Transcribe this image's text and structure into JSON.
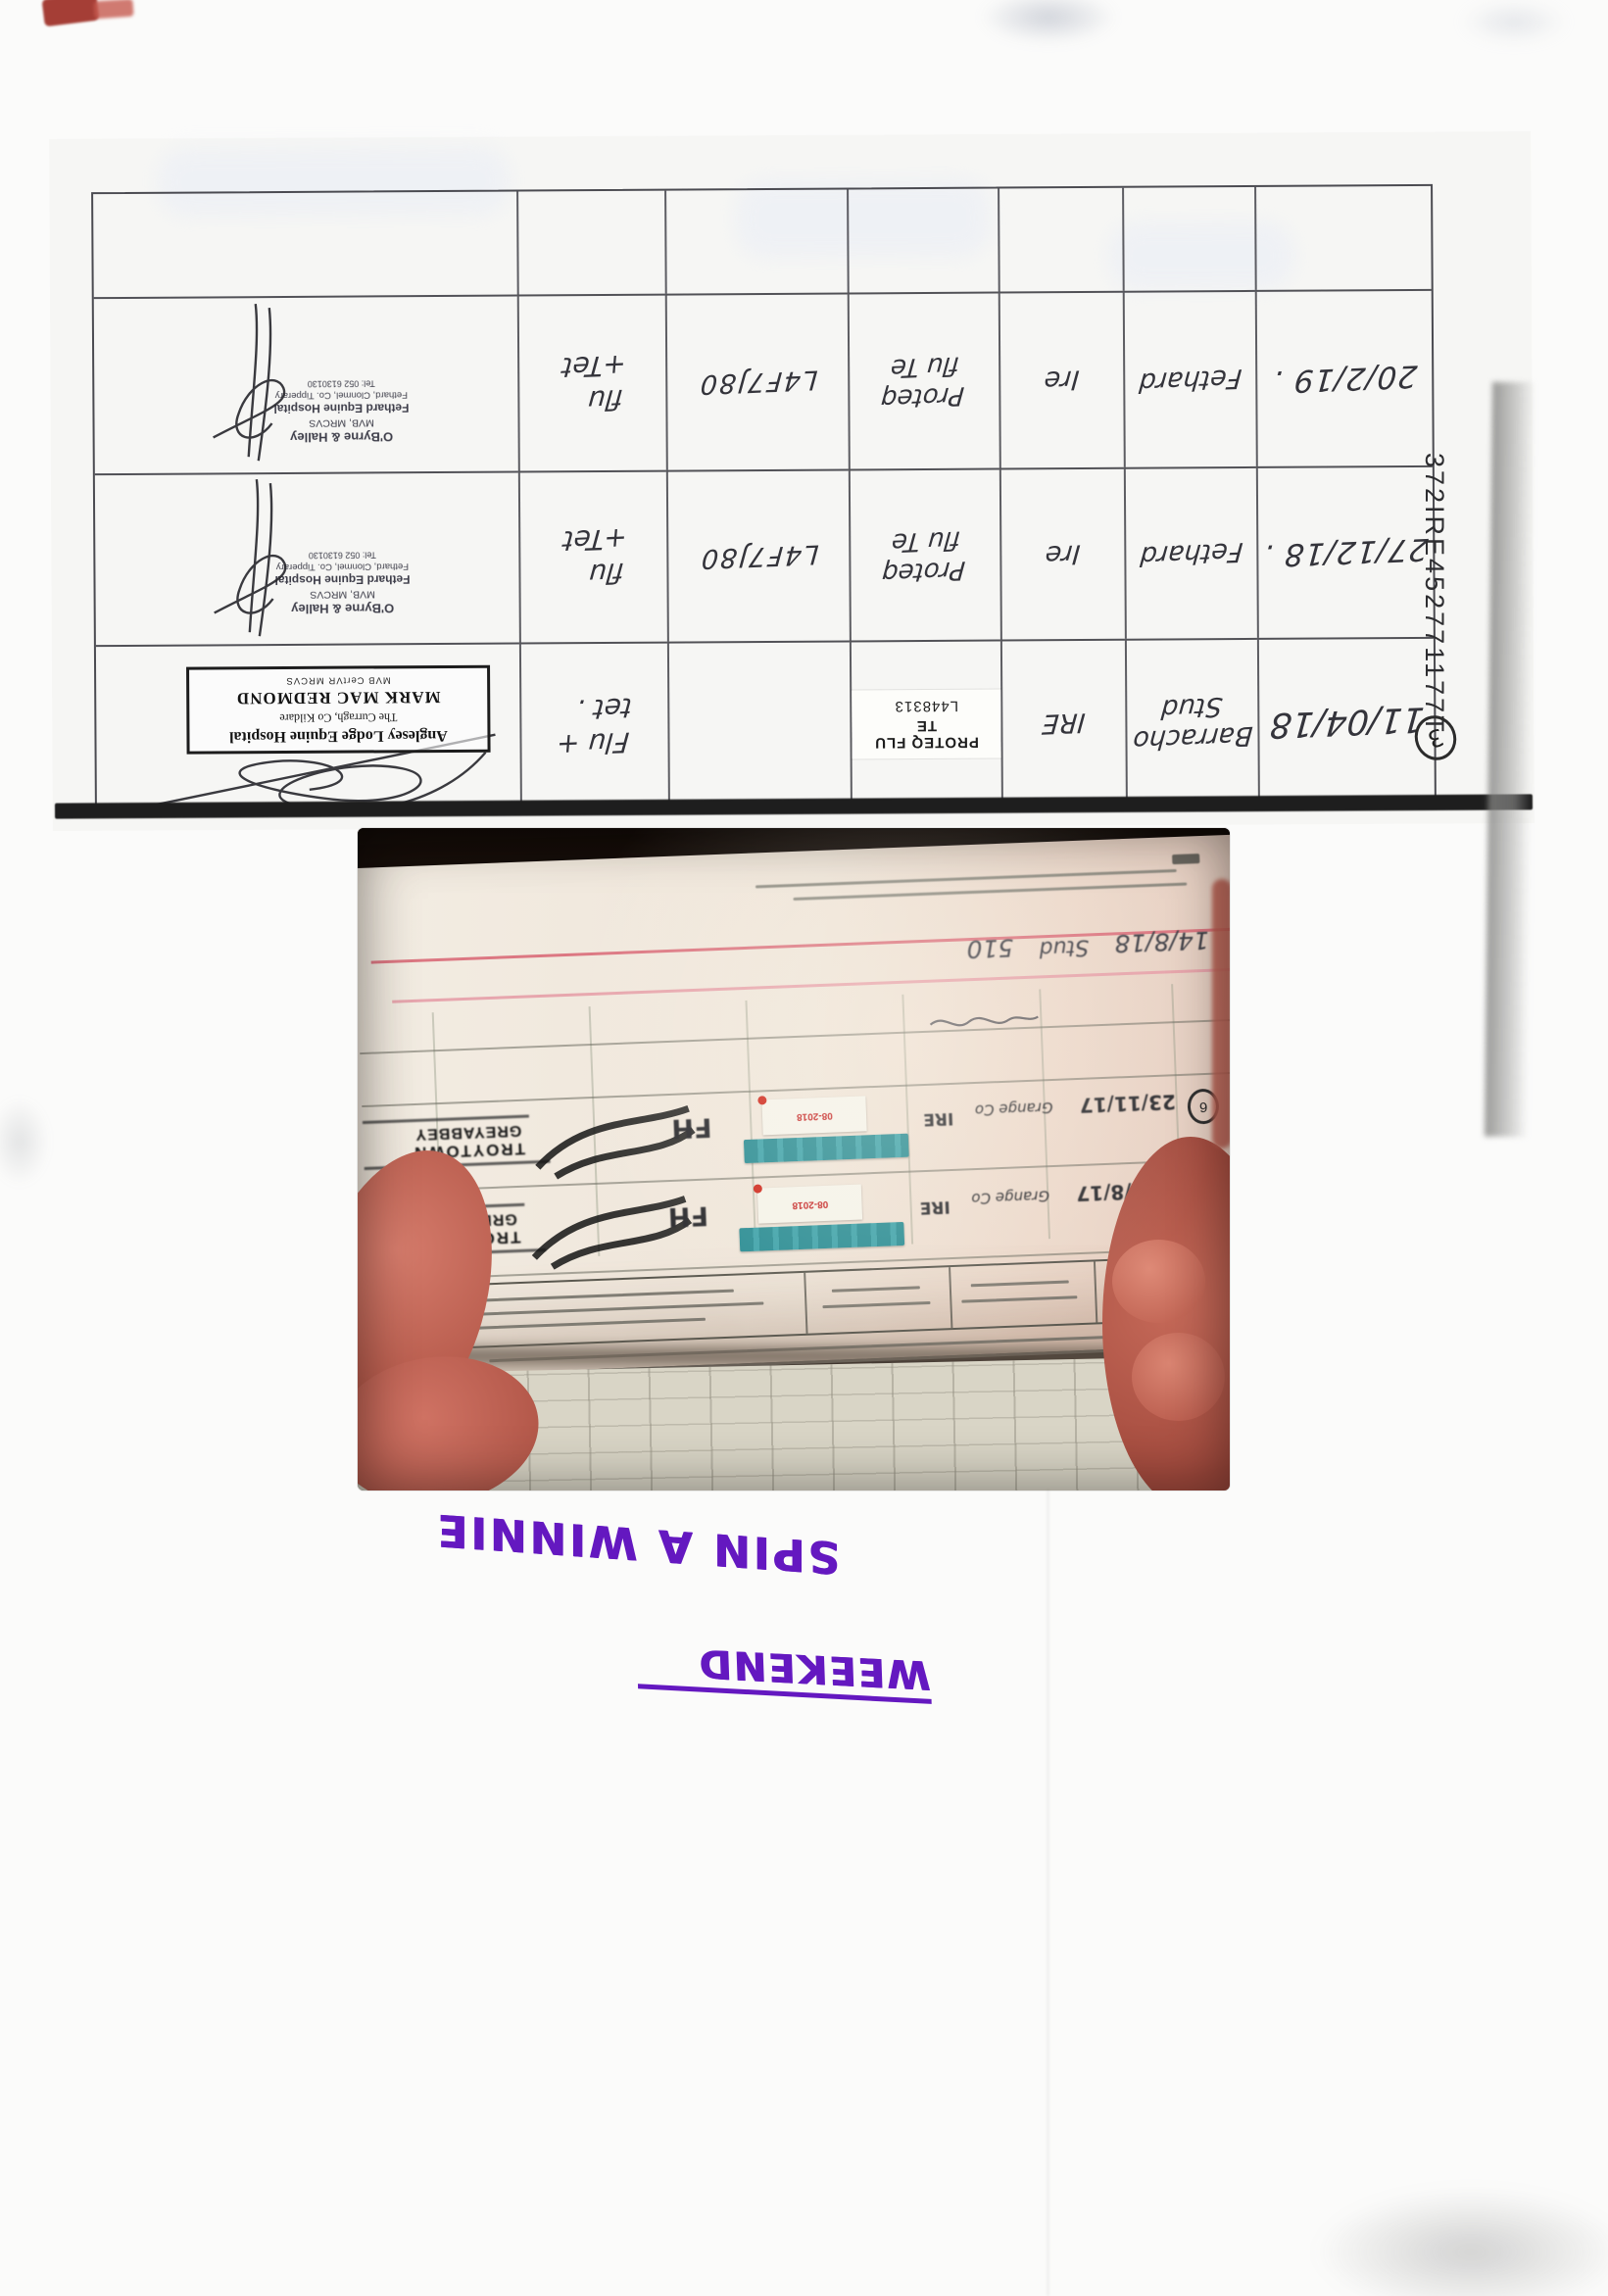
{
  "scan": {
    "passport_number": "372IRE452771177T",
    "page_circle": "3"
  },
  "table": {
    "rows": [
      {
        "date": "11/04/18",
        "place1": "Barracho",
        "place2": "Stud",
        "country": "IRE",
        "vacc1": "PROTEQ FLU TE",
        "vacc2": "L448313",
        "batch": "",
        "dis1": "Flu +",
        "dis2": "tet .",
        "stamp1": "Anglesey Lodge Equine Hospital",
        "stamp2": "The Curragh, Co Kildare",
        "stamp3": "MARK MAC REDMOND",
        "stamp4": "MVB CertVR MRCVS"
      },
      {
        "date": "27/12/18 .",
        "place1": "Fethard",
        "place2": "",
        "country": "Ire",
        "vacc1": "Proteq",
        "vacc2": "flu Te",
        "batch": "L4F7J80",
        "dis1": "flu",
        "dis2": "+Tet",
        "stamp1": "O'Byrne & Halley",
        "stamp2": "MVB, MRCVS",
        "stamp3": "Fethard Equine Hospital",
        "stamp4": "Fethard, Clonmel, Co. Tipperary",
        "stamp5": "Tel: 052 6130130"
      },
      {
        "date": "20/2/19 .",
        "place1": "Fethard",
        "place2": "",
        "country": "Ire",
        "vacc1": "Proteq",
        "vacc2": "flu Te",
        "batch": "L4F7J80",
        "dis1": "flu",
        "dis2": "+Tet",
        "stamp1": "O'Byrne & Halley",
        "stamp2": "MVB, MRCVS",
        "stamp3": "Fethard Equine Hospital",
        "stamp4": "Fethard, Clonmel, Co. Tipperary",
        "stamp5": "Tel: 052 6130130"
      }
    ]
  },
  "photo": {
    "hw_date": "14/8/18",
    "hw_word": "Stud",
    "hw_num": "510",
    "stamp_line1": "TROYTOWN",
    "stamp_line2": "GREYABBEY",
    "rows": [
      {
        "marker": "6",
        "initials": "FH",
        "sticker_date": "08-2018",
        "country": "IRE",
        "place": "Grange Co",
        "date": "23/11/17"
      },
      {
        "marker": "7",
        "initials": "FH",
        "sticker_date": "08-2018",
        "country": "IRE",
        "place": "Grange Co",
        "date": "29/8/17"
      }
    ]
  },
  "annotations": {
    "horse_name": "SPIN A WINNIE",
    "event_label": "WEEKEND"
  }
}
